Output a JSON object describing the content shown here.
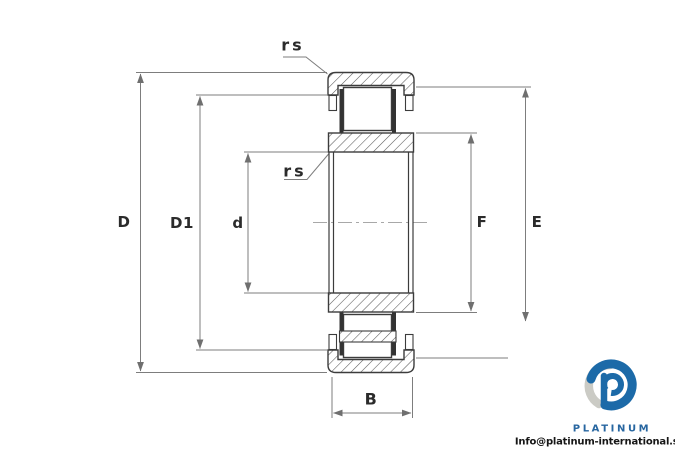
{
  "drawing": {
    "edge_labels": {
      "rs_top": "rs",
      "rs_inner": "rs"
    },
    "dimensions": {
      "outer_diameter": "D",
      "shoulder_diameter": "D1",
      "bore_diameter": "d",
      "rib_diameter": "F",
      "raceway_diameter": "E",
      "width": "B"
    }
  },
  "branding": {
    "logo_text": "PLATINUM",
    "email": "Info@platinum-international.store",
    "brand_blue": "#1c6aa8",
    "brand_gray": "#cbcbc5"
  }
}
